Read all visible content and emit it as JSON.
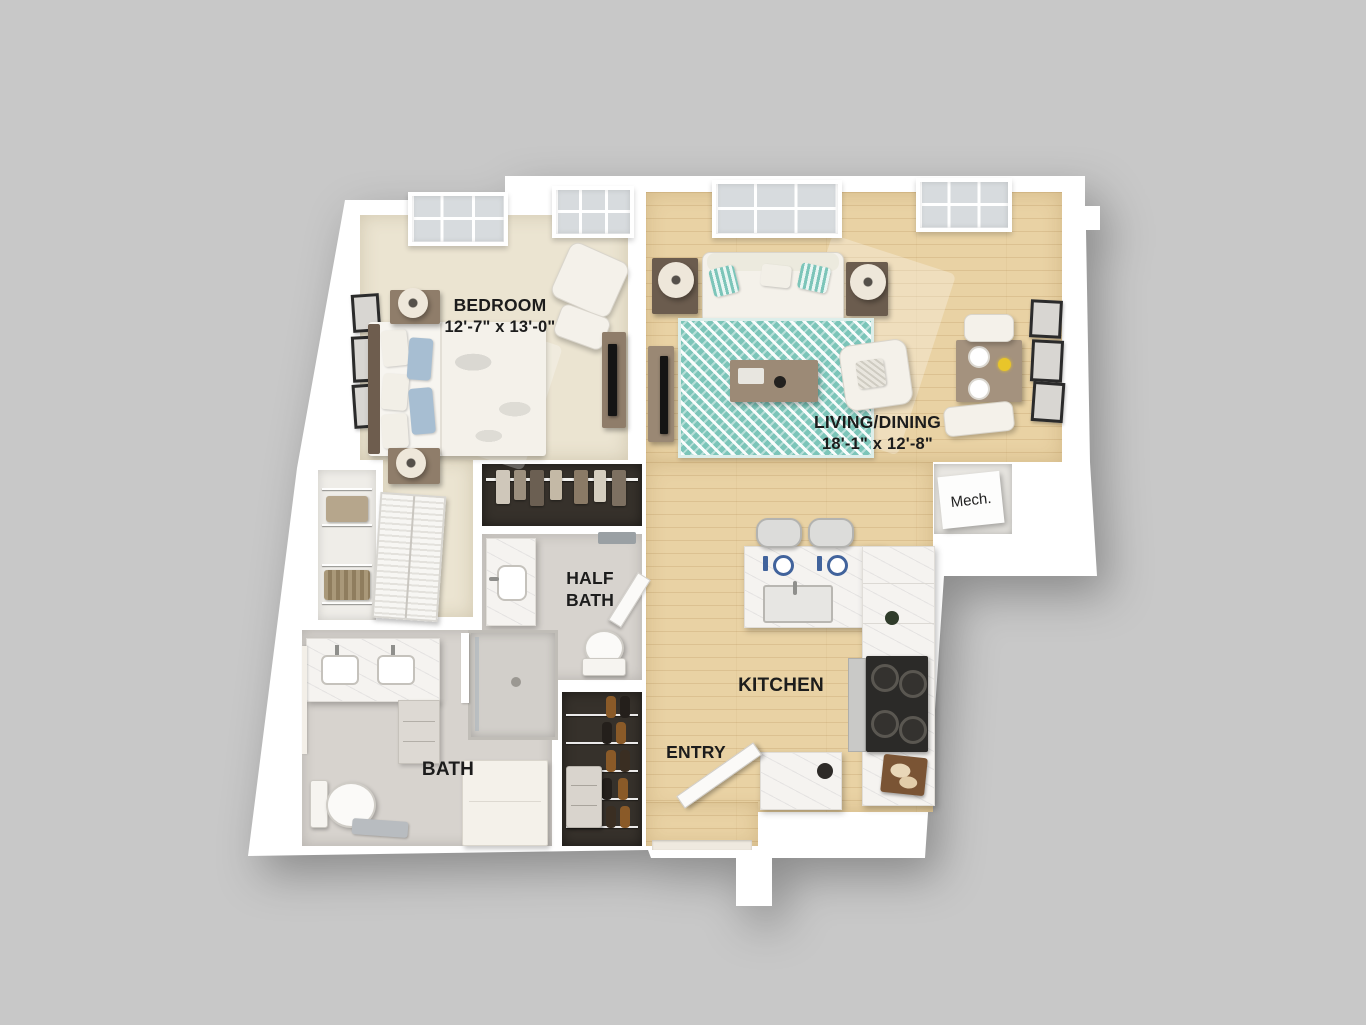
{
  "title": "Apartment 3D floor plan",
  "rooms": {
    "bedroom": {
      "name": "BEDROOM",
      "dims": "12'-7\" x 13'-0\""
    },
    "living_dining": {
      "name": "LIVING/DINING",
      "dims": "18'-1\" x 12'-8\""
    },
    "kitchen": {
      "name": "KITCHEN"
    },
    "entry": {
      "name": "ENTRY"
    },
    "bath": {
      "name": "BATH"
    },
    "half_bath": {
      "name": "HALF\nBATH"
    },
    "mech": {
      "name": "Mech."
    }
  },
  "colors": {
    "background": "#c8c8c8",
    "wall": "#ffffff",
    "carpet": "#ebe4d1",
    "wood": "#e9d2a4",
    "tile": "#d7d3ce",
    "rug_teal": "#7cc5b9",
    "closet_dark": "#36312b",
    "marble": "#f5f3f0",
    "label_text": "#1c1c1c",
    "accent_pillow_blue": "#a7bed2"
  }
}
